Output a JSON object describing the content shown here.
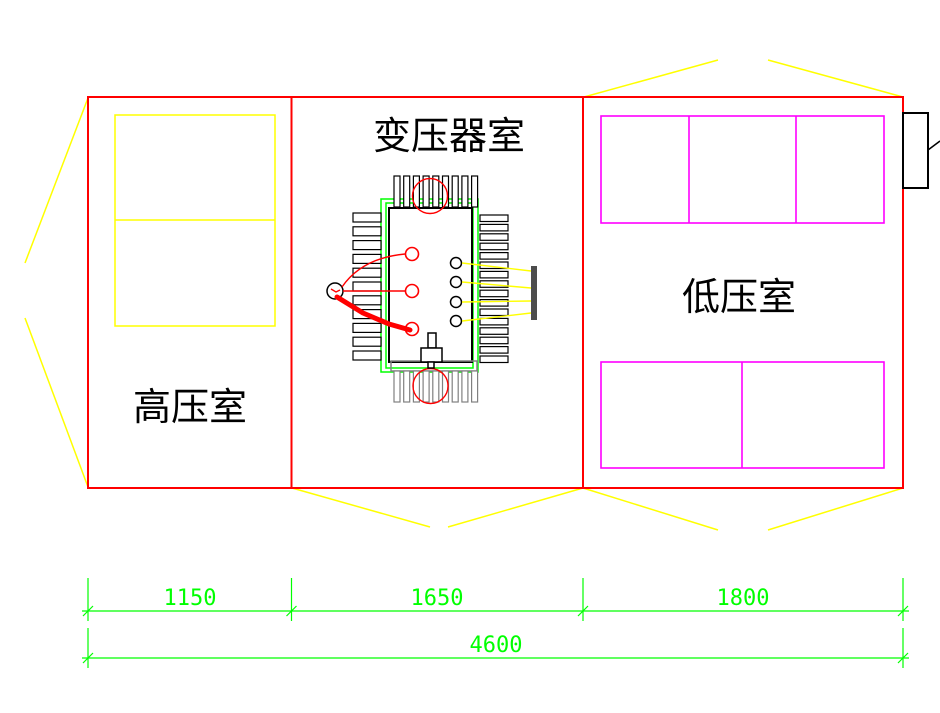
{
  "rooms": {
    "high_voltage": {
      "label": "高压室"
    },
    "transformer": {
      "label": "变压器室"
    },
    "low_voltage": {
      "label": "低压室"
    }
  },
  "dimensions": {
    "seg1": "1150",
    "seg2": "1650",
    "seg3": "1800",
    "total": "4600"
  },
  "colors": {
    "wall": "#ff0000",
    "hv_cabinet": "#ffff00",
    "lv_cabinet": "#ff00ff",
    "fold_lines": "#ffff00",
    "transformer_rail": "#00ff00",
    "dimension": "#00ff00",
    "busbar": "#4d4d4d",
    "radiator_bottom": "#808080",
    "text": "#000000"
  }
}
